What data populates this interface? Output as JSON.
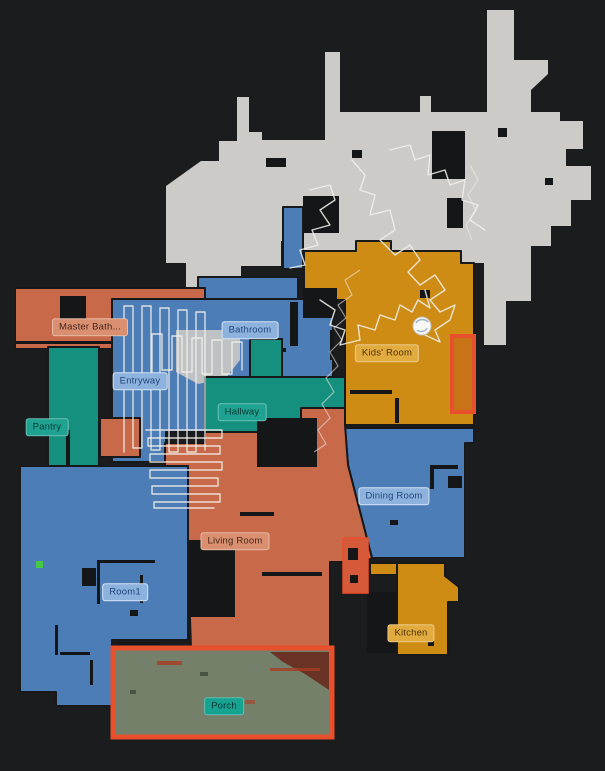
{
  "view": {
    "type": "robot-vacuum-floor-map",
    "background": "#1a1c1d"
  },
  "colors": {
    "background": "#1a1c1d",
    "unassigned_area": "#cccbc7",
    "room_salmon": "#c8694a",
    "room_blue": "#4c7db7",
    "room_teal": "#16907e",
    "room_mustard": "#ce8c15",
    "porch_fill": "#75806b",
    "zone_highlight_red": "#e8502d",
    "robot_path_white": "#f0efe9",
    "wall_dark": "#17191b",
    "green_marker": "#46c846"
  },
  "rooms": {
    "master_bath": {
      "label": "Master Bath...",
      "color": "#c8694a"
    },
    "bathroom": {
      "label": "Bathroom",
      "color": "#4c7db7"
    },
    "kids_room": {
      "label": "Kids' Room",
      "color": "#ce8c15"
    },
    "entryway": {
      "label": "Entryway",
      "color": "#4c7db7"
    },
    "hallway": {
      "label": "Hallway",
      "color": "#16907e"
    },
    "pantry": {
      "label": "Pantry",
      "color": "#16907e"
    },
    "dining_room": {
      "label": "Dining Room",
      "color": "#4c7db7"
    },
    "living_room": {
      "label": "Living Room",
      "color": "#c8694a"
    },
    "room1": {
      "label": "Room1",
      "color": "#4c7db7"
    },
    "kitchen": {
      "label": "Kitchen",
      "color": "#ce8c15"
    },
    "porch": {
      "label": "Porch",
      "color": "#75806b"
    }
  },
  "icons": {
    "robot": "robot-vacuum-circle-icon"
  }
}
